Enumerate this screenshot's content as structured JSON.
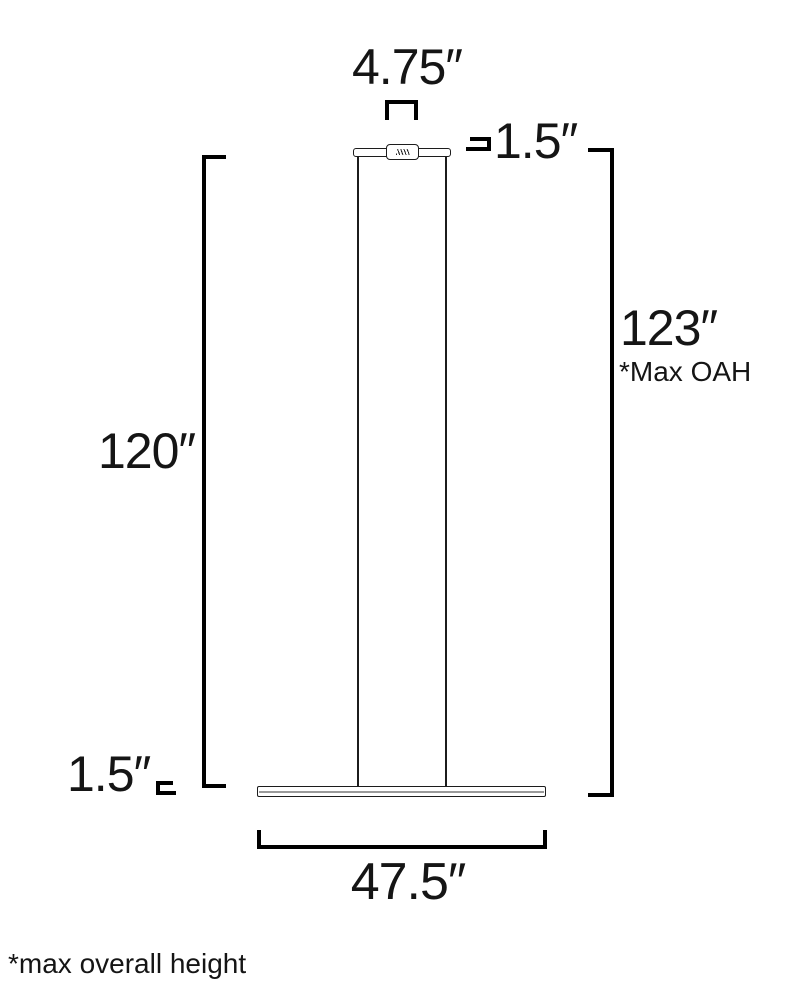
{
  "diagram": {
    "type": "linear-pendant-dimension-drawing",
    "dimensions": {
      "canopy_width": "4.75″",
      "canopy_height": "1.5″",
      "max_overall_height_value": "123″",
      "max_overall_height_label": "*Max OAH",
      "suspension_height": "120″",
      "fixture_height": "1.5″",
      "fixture_width": "47.5″"
    },
    "footnote": "*max overall height",
    "colors": {
      "dimension_line": "#000000",
      "fixture_outline": "#1c1c1c",
      "fixture_inner_line": "#9a9a9a",
      "background": "#ffffff"
    }
  }
}
